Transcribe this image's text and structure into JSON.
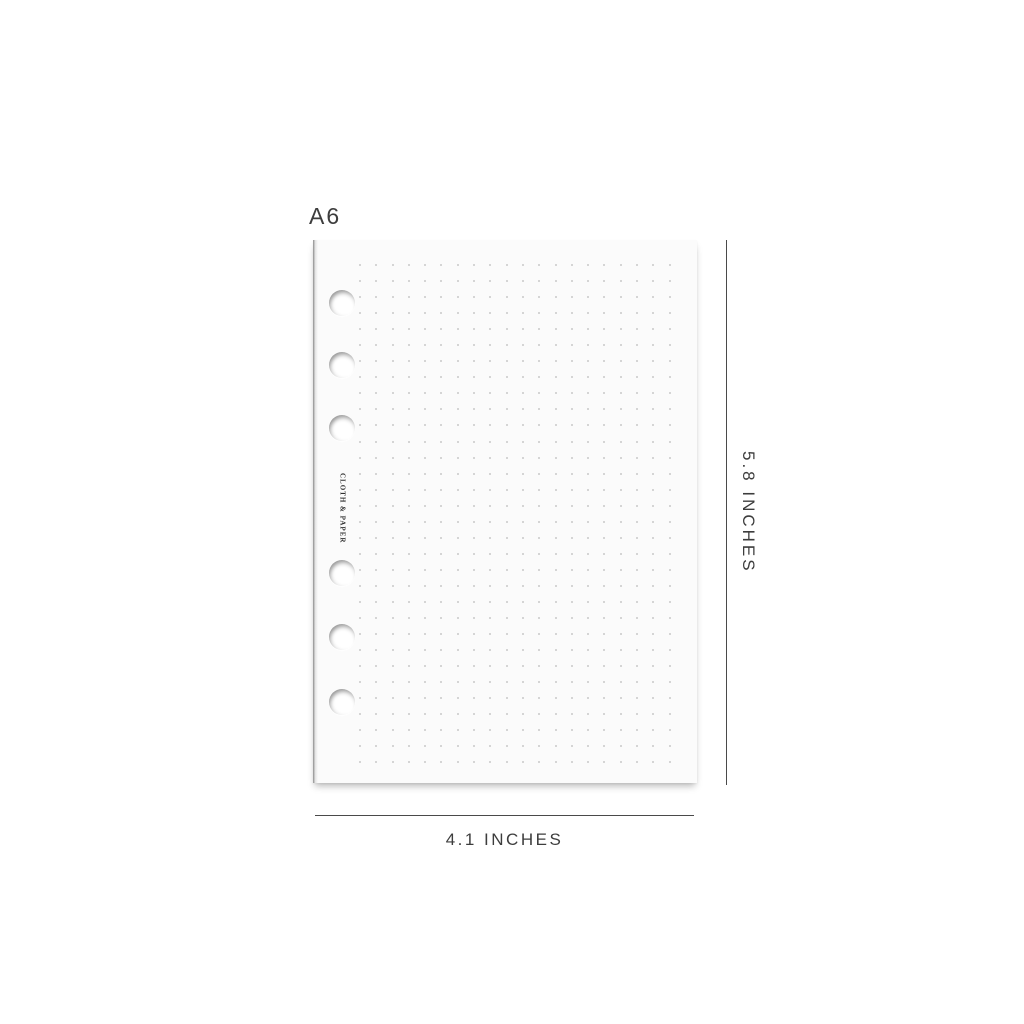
{
  "product": {
    "size_label": "A6",
    "brand_label": "CLOTH & PAPER"
  },
  "dimensions": {
    "height_label": "5.8 INCHES",
    "width_label": "4.1 INCHES"
  },
  "paper": {
    "hole_count": 6,
    "hole_offsets_y": [
      63,
      125,
      188,
      333,
      397,
      462
    ],
    "hole_diameter": 26,
    "dot_grid": {
      "rows": 32,
      "columns": 20,
      "spacing_x": 16.3,
      "spacing_y": 16.05,
      "dot_size": 2
    }
  },
  "colors": {
    "background": "#ffffff",
    "paper": "#fbfbfb",
    "paper_edge": "#8c8c8c",
    "dot": "#c9c9c9",
    "dimension_line": "#4a4a4a",
    "label_text": "#3d3d3d",
    "brand_text": "#2f2f2f"
  }
}
